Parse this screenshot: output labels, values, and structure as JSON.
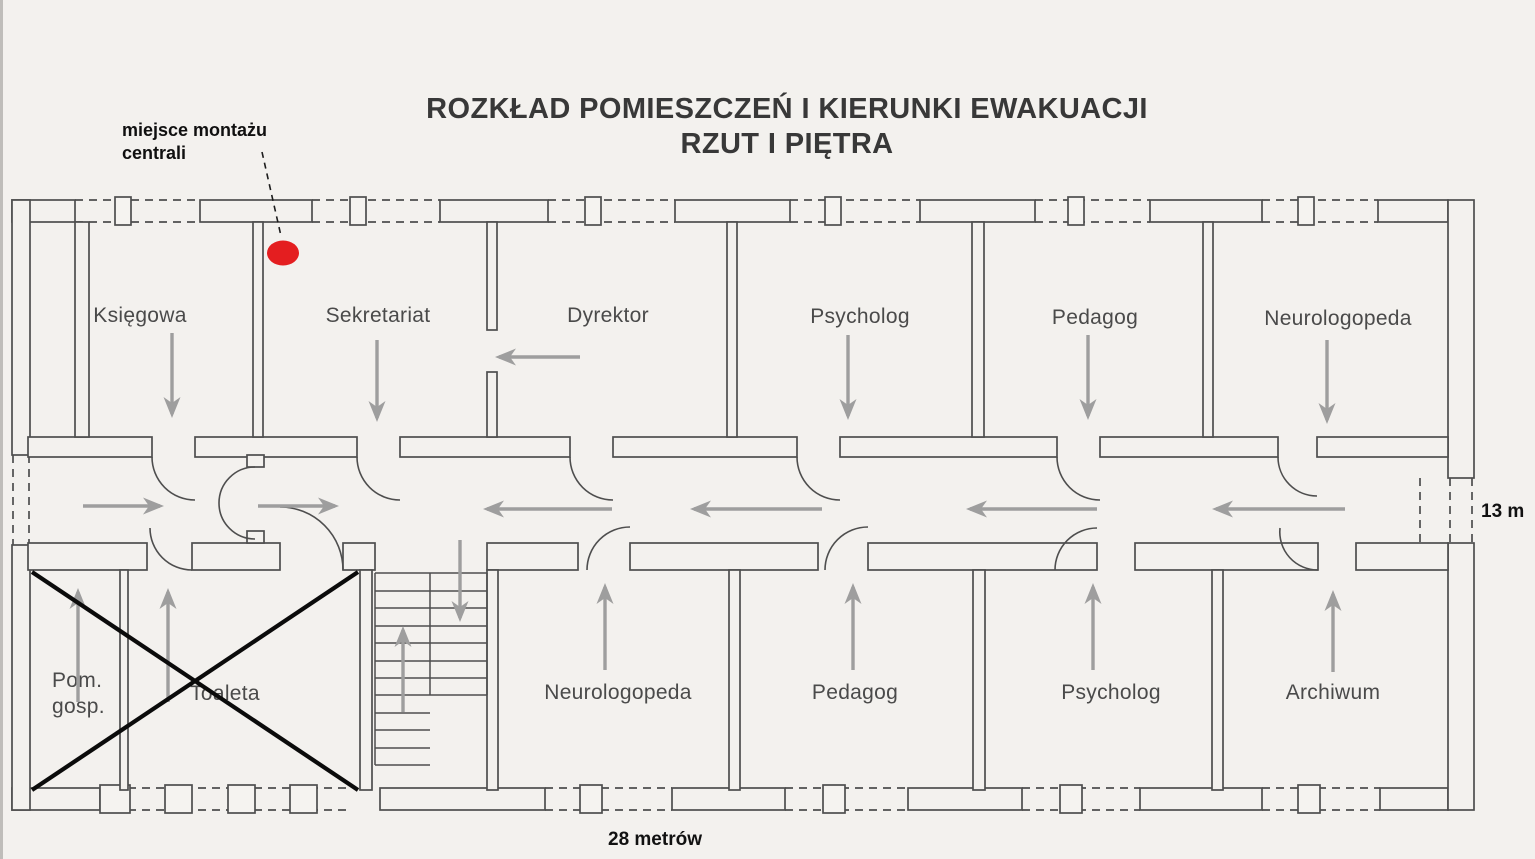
{
  "title": {
    "line1": "ROZKŁAD POMIESZCZEŃ I KIERUNKI EWAKUACJI",
    "line2": "RZUT I PIĘTRA"
  },
  "annotation": {
    "central_unit_label": "miejsce montażu centrali"
  },
  "dimensions": {
    "building_width": "28 metrów",
    "building_depth": "13 m"
  },
  "rooms": {
    "top": [
      {
        "name": "Księgowa",
        "evac_direction": "down"
      },
      {
        "name": "Sekretariat",
        "evac_direction": "down"
      },
      {
        "name": "Dyrektor",
        "evac_direction": "left"
      },
      {
        "name": "Psycholog",
        "evac_direction": "down"
      },
      {
        "name": "Pedagog",
        "evac_direction": "down"
      },
      {
        "name": "Neurologopeda",
        "evac_direction": "down"
      }
    ],
    "bottom": [
      {
        "name": "Pom. gosp.",
        "evac_direction": "up",
        "crossed_out": true
      },
      {
        "name": "Toaleta",
        "evac_direction": "up",
        "crossed_out": true
      },
      {
        "name": "Neurologopeda",
        "evac_direction": "up"
      },
      {
        "name": "Pedagog",
        "evac_direction": "up"
      },
      {
        "name": "Psycholog",
        "evac_direction": "up"
      },
      {
        "name": "Archiwum",
        "evac_direction": "up"
      }
    ]
  },
  "corridor": {
    "flow": [
      "right",
      "right",
      "left",
      "left",
      "left",
      "left"
    ],
    "stair_flow": [
      "down",
      "up"
    ]
  },
  "colors": {
    "marker_red": "#e41e20",
    "arrow_gray": "#9e9e9e",
    "wall_line": "#4e4e4e",
    "cross_black": "#0b0b0b"
  }
}
